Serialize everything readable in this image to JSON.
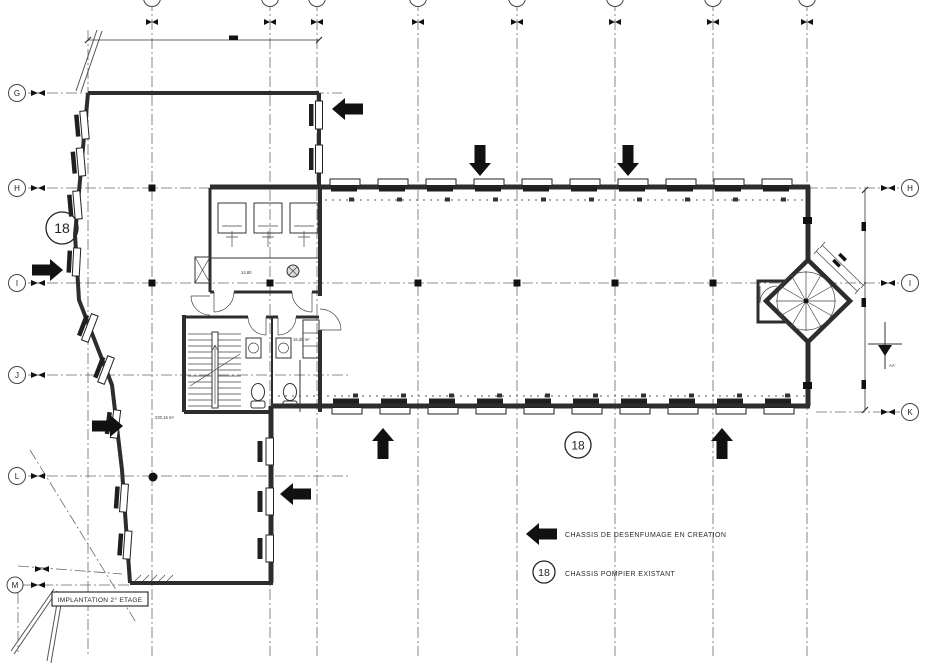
{
  "drawing": {
    "title_block": {
      "label": "IMPLANTATION 2° ETAGE"
    },
    "legend": {
      "smoke_vent": {
        "label": "CHASSIS DE DESENFUMAGE EN CREATION"
      },
      "fire_window": {
        "badge": "18",
        "label": "CHASSIS POMPIER EXISTANT"
      }
    },
    "grid": {
      "left_labels": [
        "G",
        "H",
        "I",
        "J",
        "L",
        "M"
      ],
      "right_labels": [
        "H",
        "I",
        "K"
      ]
    },
    "markers": {
      "left": "18",
      "bottom": "18"
    },
    "section": {
      "label": "AA'"
    },
    "annotations": {
      "dim_shower": "14,80",
      "area_wc": "15,28 m²",
      "area_hall": "220,15 m²"
    },
    "colors": {
      "ink": "#2b2b2b",
      "paper": "#ffffff"
    }
  }
}
